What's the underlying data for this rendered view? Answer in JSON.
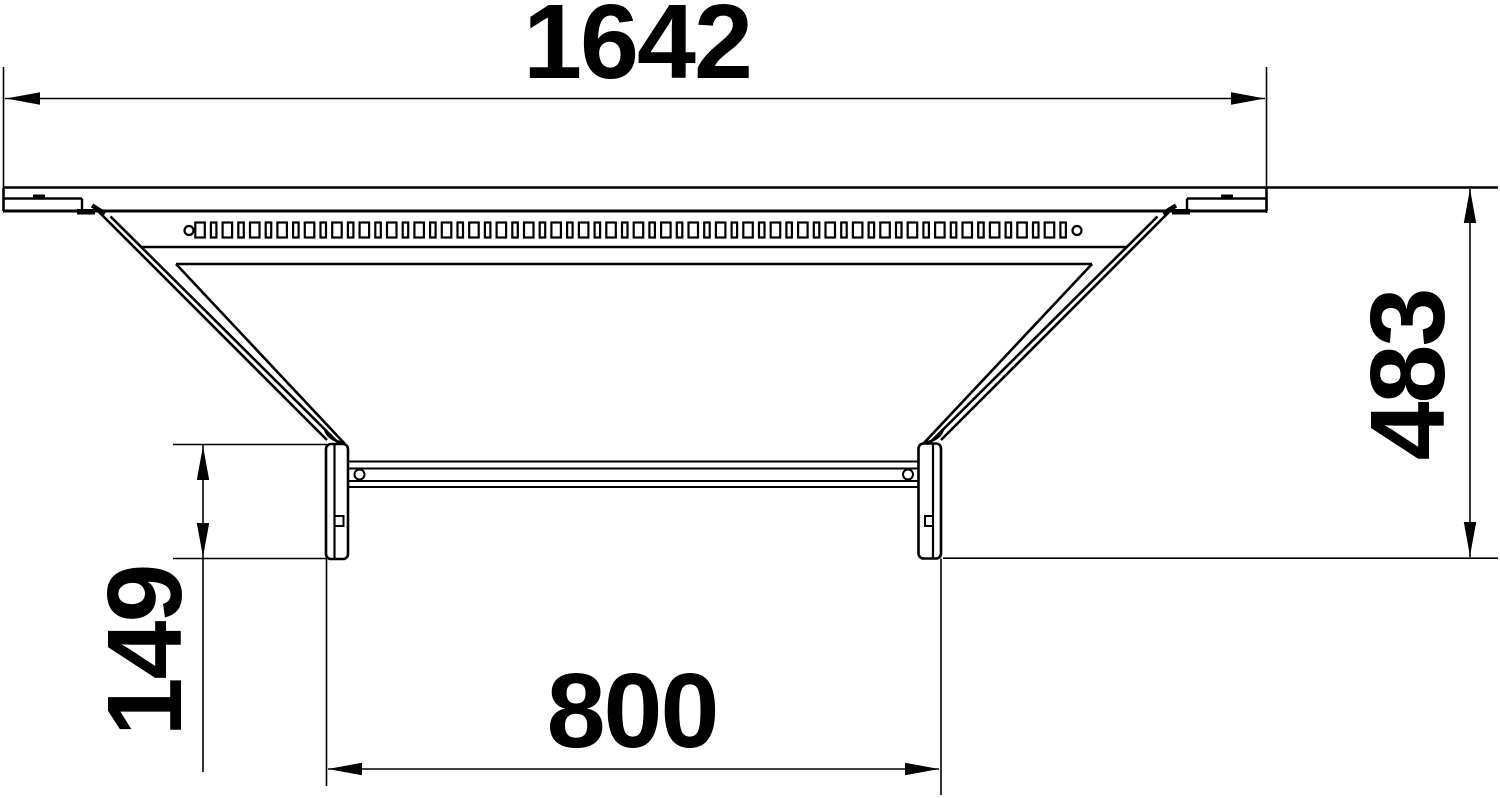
{
  "page": {
    "background": "#ffffff",
    "line_color": "#000000"
  },
  "drawing": {
    "description": "technical dimension drawing, top view of cable tray add-on tee",
    "dimensions": {
      "overall_width": {
        "value": "1642",
        "position": "top",
        "orientation": "horizontal"
      },
      "overall_depth": {
        "value": "483",
        "position": "right",
        "orientation": "vertical"
      },
      "branch_end_height": {
        "value": "149",
        "position": "left",
        "orientation": "vertical"
      },
      "branch_width": {
        "value": "800",
        "position": "bottom",
        "orientation": "horizontal"
      }
    },
    "perforation_row": {
      "start_x": 200,
      "end_x": 1070,
      "pitch": 13.7,
      "hole_y": 222.5,
      "hole_height": 15,
      "wide_width": 9.5,
      "narrow_width": 5.5,
      "hole_cy": 230.5,
      "end_hole_radius": 4.5,
      "left_end_hole_cx": 189,
      "right_end_hole_cx": 1077
    }
  }
}
